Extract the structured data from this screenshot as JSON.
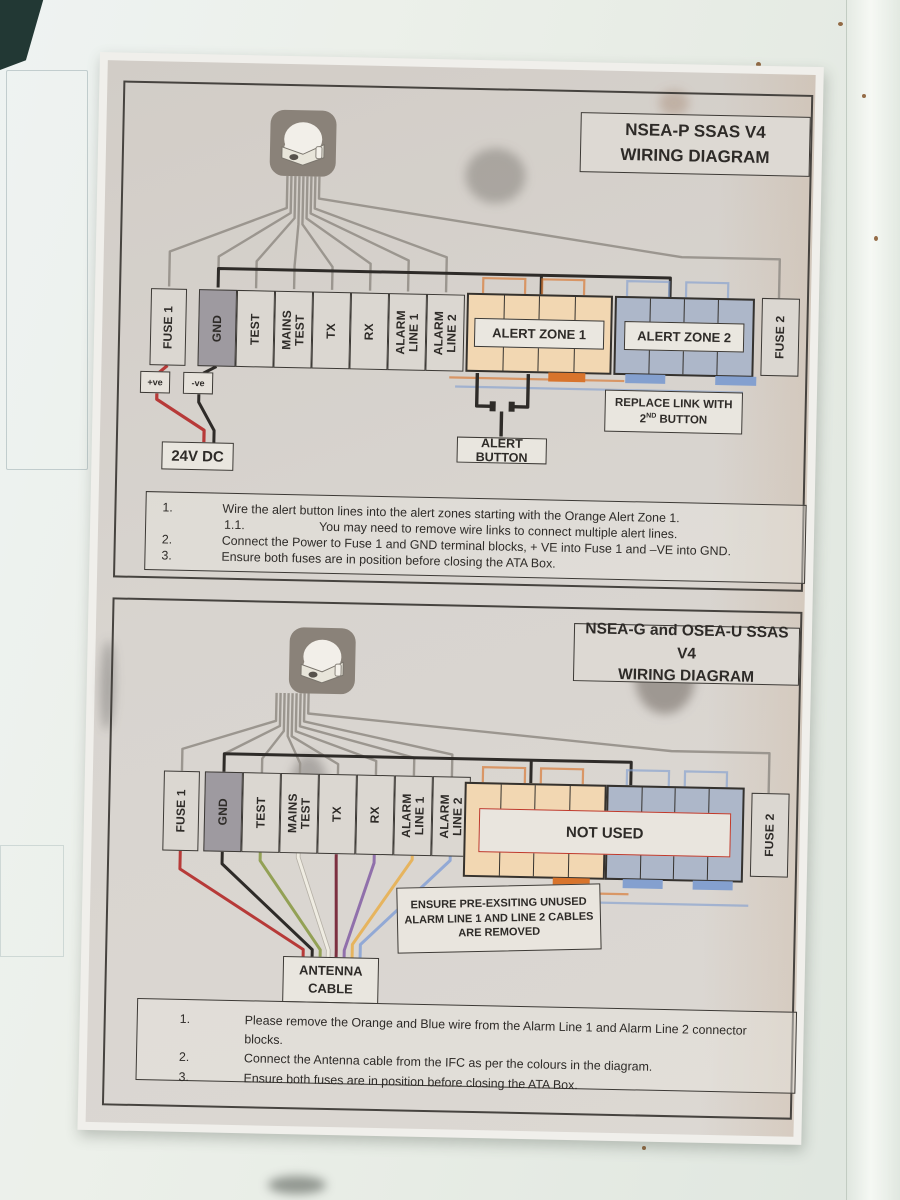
{
  "colors": {
    "zone1_orange": "#f2d7b2",
    "zone2_blue": "#adb7c9",
    "wire_red": "#b73a38",
    "wire_black": "#2e2b28",
    "wire_green": "#93a155",
    "wire_white": "#efece2",
    "wire_maroon": "#7c3040",
    "wire_purple": "#9070ab",
    "wire_yellow": "#e6b45e",
    "wire_blue": "#92a9d5",
    "wire_gray": "#9b968f",
    "notused_red": "#c0392b",
    "link_orange": "#d8742c",
    "link_blue": "#84a0cf"
  },
  "terminals": {
    "labels": [
      "FUSE 1",
      "GND",
      "TEST",
      "MAINS\nTEST",
      "TX",
      "RX",
      "ALARM\nLINE 1",
      "ALARM\nLINE 2"
    ],
    "fuse2": "FUSE 2"
  },
  "diagram1": {
    "title1": "NSEA-P SSAS V4",
    "title2": "WIRING DIAGRAM",
    "zone1": "ALERT ZONE 1",
    "zone2": "ALERT ZONE 2",
    "pos": "+ve",
    "neg": "-ve",
    "power": "24V DC",
    "alert_button": "ALERT BUTTON",
    "replace_link1": "REPLACE LINK WITH",
    "replace_link2_base": "2",
    "replace_link2_sup": "ND",
    "replace_link2_rest": " BUTTON",
    "steps": [
      {
        "num": "1.",
        "text": "Wire the alert button lines into the alert zones starting with the Orange Alert Zone 1."
      },
      {
        "num": "1.1.",
        "text": "You may need to remove wire links to connect multiple alert lines."
      },
      {
        "num": "2.",
        "text": "Connect the Power to Fuse 1 and GND terminal blocks, + VE into Fuse 1 and –VE into GND."
      },
      {
        "num": "3.",
        "text": "Ensure both fuses are in position before closing the ATA Box."
      }
    ]
  },
  "diagram2": {
    "title1": "NSEA-G and OSEA-U SSAS V4",
    "title2": "WIRING DIAGRAM",
    "not_used": "NOT USED",
    "antenna_cable": "ANTENNA\nCABLE",
    "note": "ENSURE PRE-EXSITING UNUSED\nALARM LINE 1 AND LINE 2 CABLES\nARE REMOVED",
    "steps": [
      {
        "num": "1.",
        "text": "Please remove the Orange and Blue wire from the Alarm Line 1 and Alarm Line 2 connector blocks."
      },
      {
        "num": "2.",
        "text": "Connect the Antenna cable from the IFC as per the colours in the diagram."
      },
      {
        "num": "3.",
        "text": "Ensure both fuses are in position before closing the ATA Box."
      }
    ]
  }
}
